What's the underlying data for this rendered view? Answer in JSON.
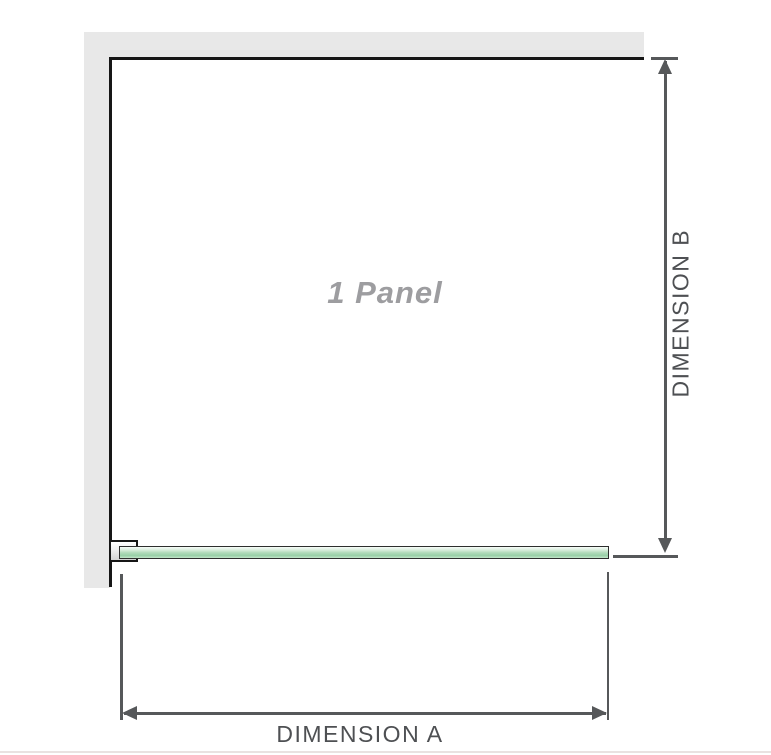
{
  "diagram": {
    "panel_label": "1 Panel",
    "dimension_a_label": "DIMENSION A",
    "dimension_b_label": "DIMENSION B"
  },
  "colors": {
    "wall_fill": "#e8e8e8",
    "panel_outline": "#161616",
    "glass_green": "#9ccfa8",
    "bracket_fill": "#e0e0e0",
    "dimension_line": "#56585a",
    "dimension_text": "#4e5053",
    "panel_text": "#9d9da0"
  }
}
